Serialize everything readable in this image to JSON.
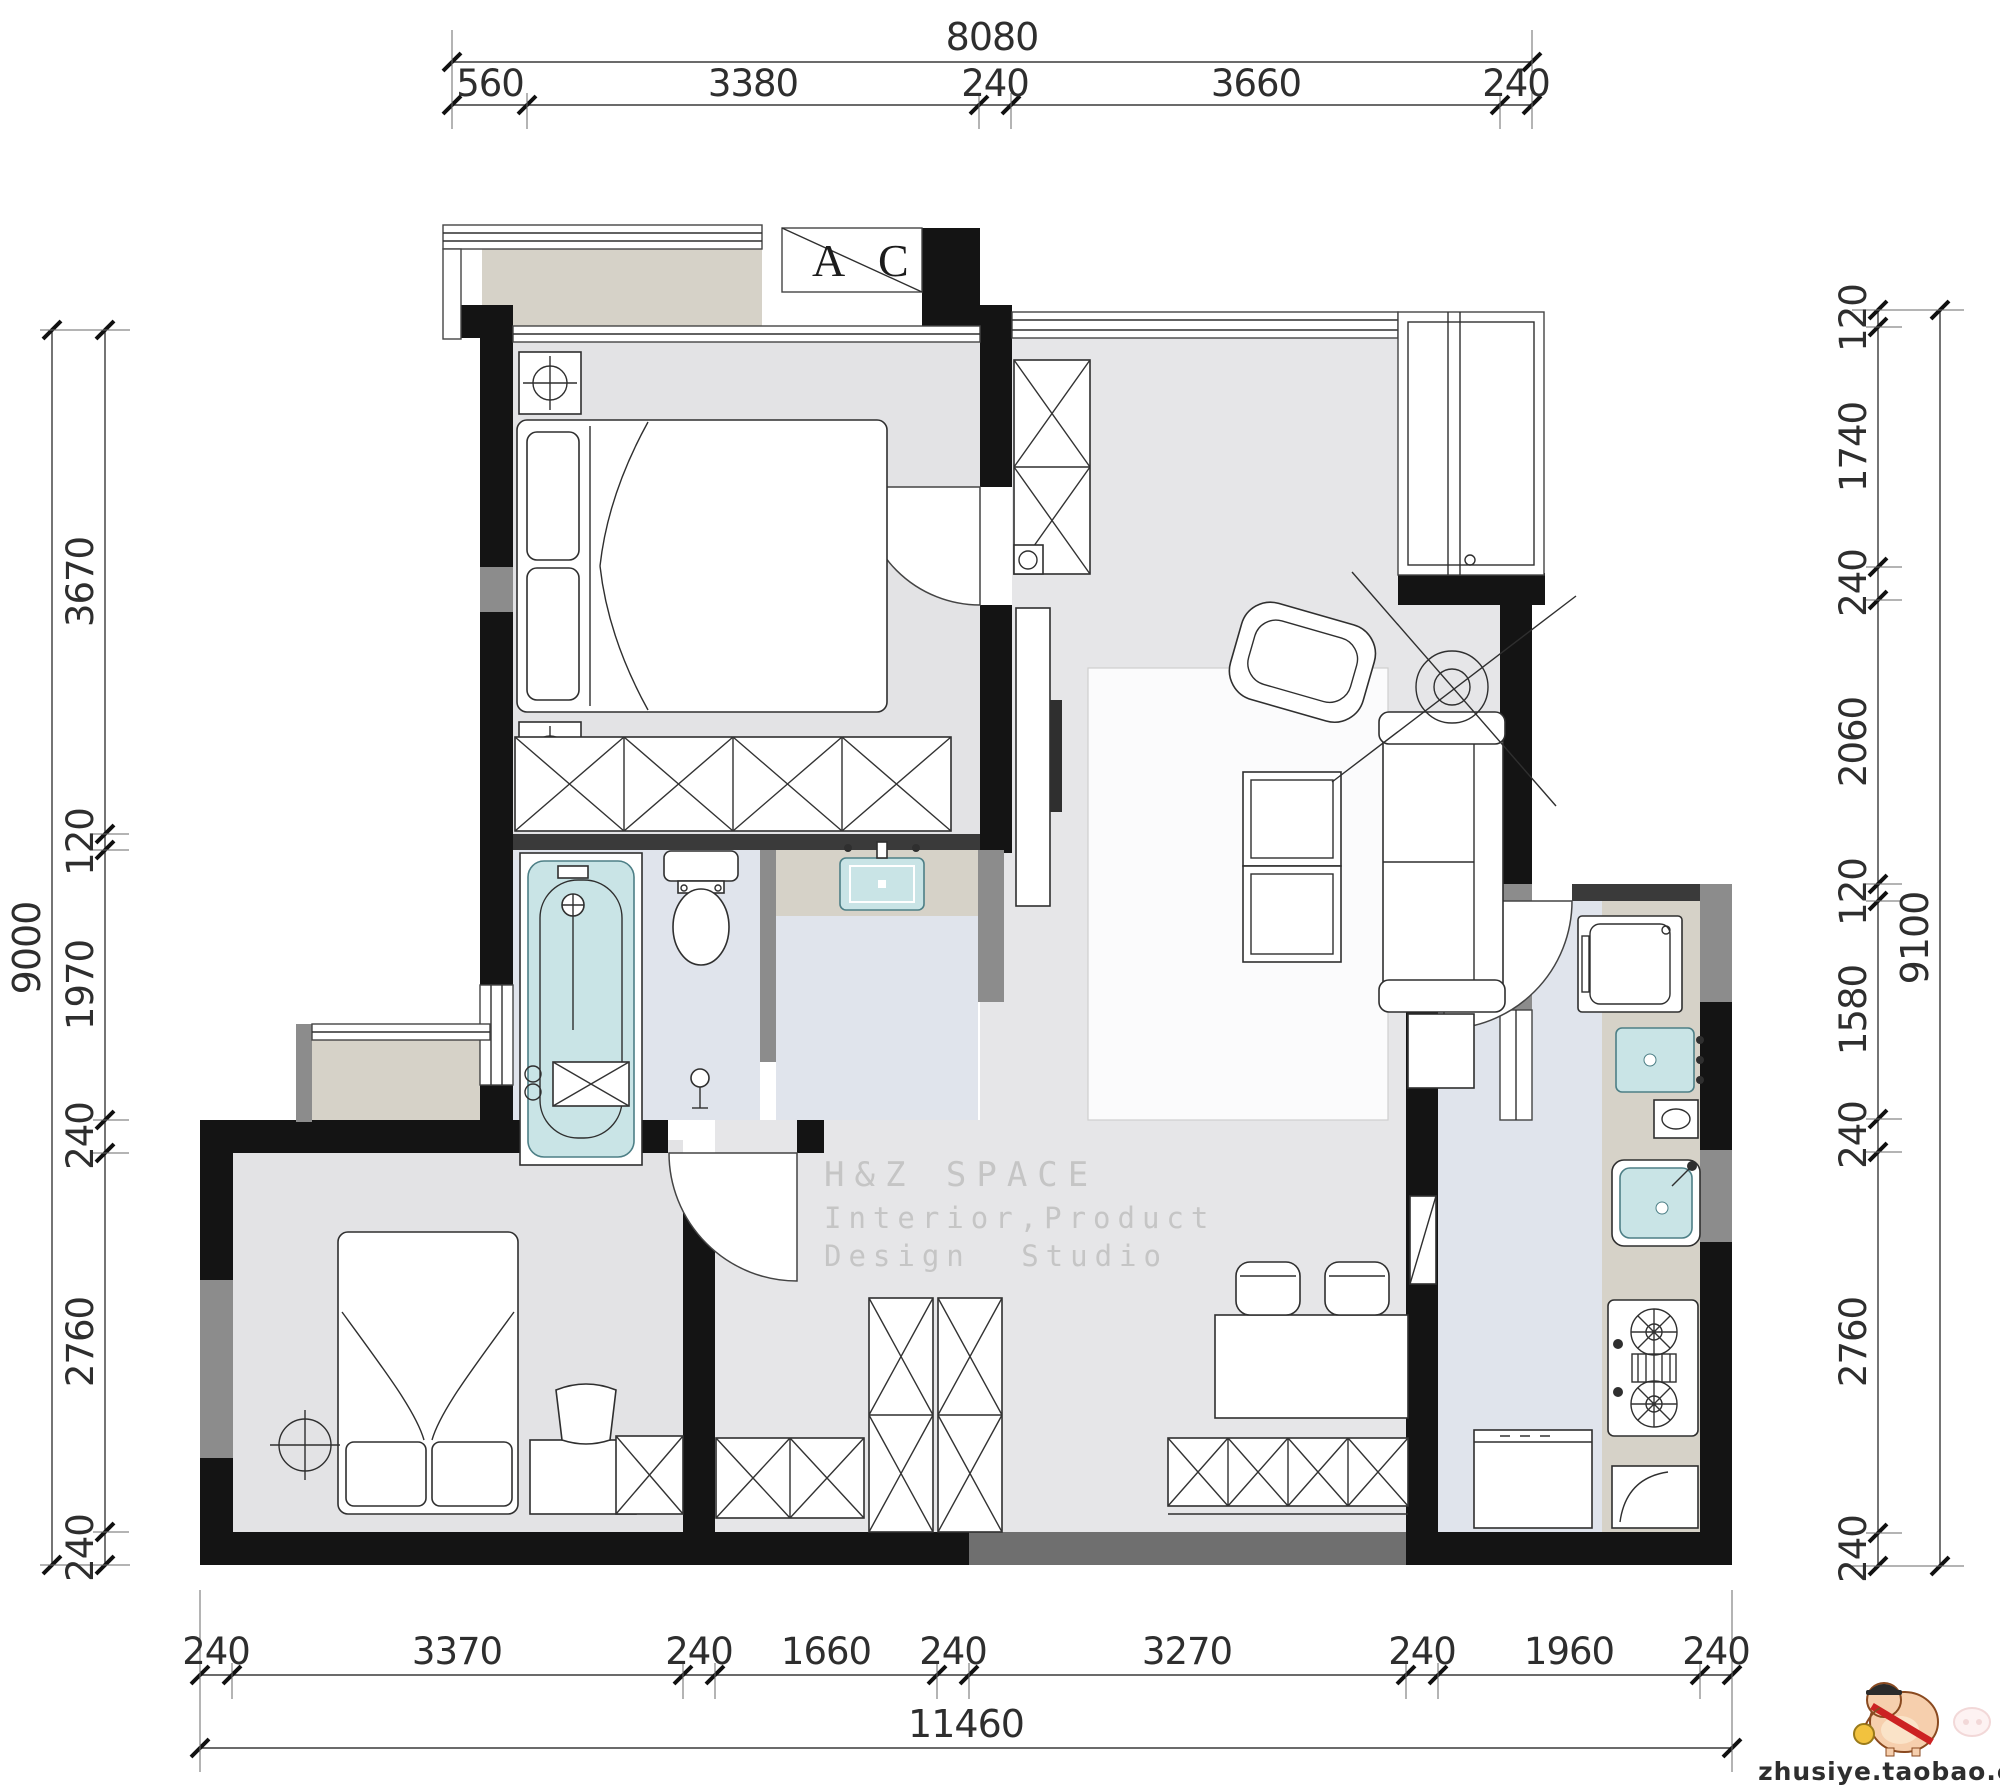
{
  "watermark": {
    "line1": "H&Z SPACE",
    "line2": "Interior,Product",
    "line3": "Design Studio"
  },
  "window_label": {
    "a": "A",
    "c": "C"
  },
  "logo": {
    "site": "zhusiye.taobao.com",
    "icon": "pig-mascot-icon"
  },
  "dimensions": {
    "top": {
      "total": "8080",
      "segments": [
        "560",
        "3380",
        "240",
        "3660",
        "240"
      ]
    },
    "left": {
      "total": "9000",
      "segments": [
        "3670",
        "120",
        "1970",
        "240",
        "2760",
        "240"
      ]
    },
    "right": {
      "total": "9100",
      "segments": [
        "120",
        "1740",
        "240",
        "2060",
        "120",
        "1580",
        "240",
        "2760",
        "240"
      ]
    },
    "bottom": {
      "total": "11460",
      "segments": [
        "240",
        "3370",
        "240",
        "1660",
        "240",
        "3270",
        "240",
        "1960",
        "240"
      ]
    }
  },
  "colors": {
    "wall": "#141414",
    "half_wall_gray": "#8c8c8c",
    "floor_main": "#e6e6e8",
    "floor_wet": "#e0e4ec",
    "counter_beige": "#d6d2c8",
    "fixture_teal": "#c9e4e6",
    "dimension_text": "#2e2e2e",
    "watermark_gray": "#c5c5c5"
  }
}
